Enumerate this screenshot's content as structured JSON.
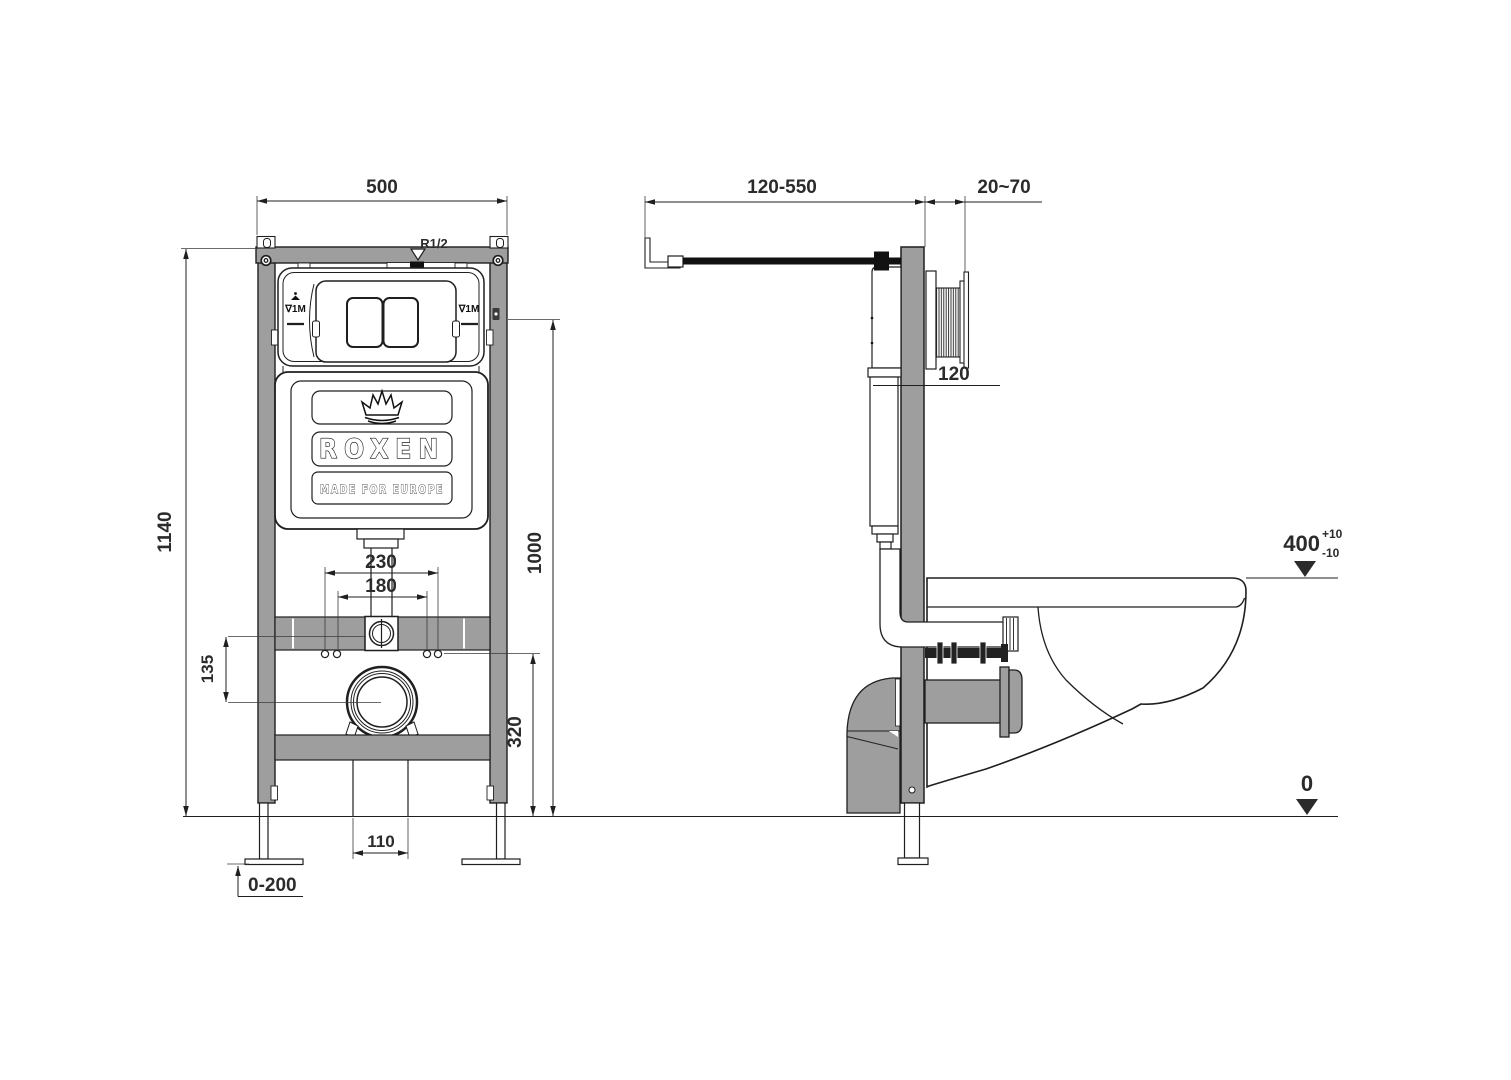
{
  "drawing": {
    "title_note": "wall-hung toilet installation frame, two views",
    "front_view": {
      "frame_width": "500",
      "frame_height": "1140",
      "plate_height": "1000",
      "inlet_spacing": "230",
      "stud_spacing": "180",
      "inlet_drop": "135",
      "outlet_height": "320",
      "outlet_width": "110",
      "foot_adjust_range": "0-200",
      "water_thread": "R1/2",
      "level_mark": "∇1M"
    },
    "side_view": {
      "bracket_range": "120-550",
      "wall_finish_range": "20~70",
      "tank_depth": "120",
      "bowl_level": "400",
      "bowl_level_tol_plus": "+10",
      "bowl_level_tol_minus": "-10",
      "floor_level": "0"
    },
    "brand": {
      "logo": "ROXEN",
      "tagline": "MADE FOR EUROPE"
    }
  },
  "colors": {
    "line": "#1f1f1f",
    "frame_gray": "#9e9e9e",
    "text": "#2b2b2b",
    "background": "#ffffff"
  }
}
